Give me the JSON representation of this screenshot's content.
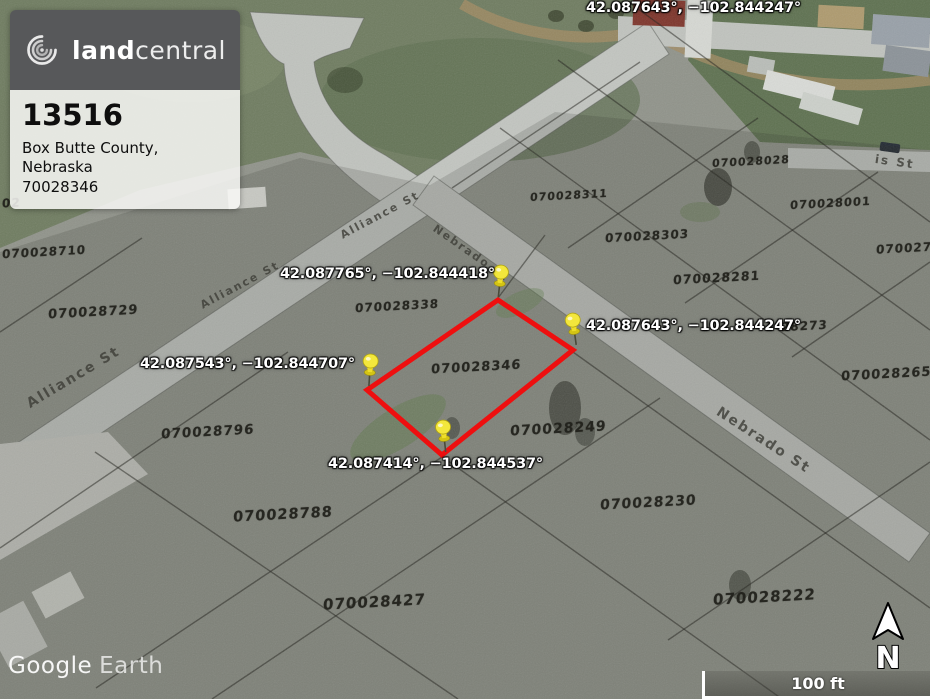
{
  "listing_card": {
    "brand_land": "land",
    "brand_central": "central",
    "listing_id": "13516",
    "location": "Box Butte County, Nebraska",
    "parcel_number": "70028346"
  },
  "pins": [
    {
      "label": "42.087765°, −102.844418°"
    },
    {
      "label": "42.087643°, −102.844247°"
    },
    {
      "label": "42.087543°, −102.844707°"
    },
    {
      "label": "42.087414°, −102.844537°"
    }
  ],
  "parcel_labels": [
    "02",
    "070028710",
    "070028729",
    "070028311",
    "070028028",
    "070028001",
    "070028303",
    "0700279",
    "070028281",
    "28273",
    "070028265",
    "070028338",
    "070028346",
    "070028249",
    "070028796",
    "070028788",
    "070028230",
    "070028427",
    "070028222"
  ],
  "street_labels": [
    "Alliance St",
    "Nebrado St",
    "Alliance St",
    "Alliance St",
    "Nebrado St",
    "is St"
  ],
  "watermark": {
    "google": "Google",
    "earth": "Earth"
  },
  "compass": {
    "north_label": "N"
  },
  "scale_bar": {
    "label": "100 ft"
  },
  "colors": {
    "boundary_red": "#ee0f0f",
    "pin_yellow": "#f3e73c",
    "card_header_gray": "#57585a"
  }
}
